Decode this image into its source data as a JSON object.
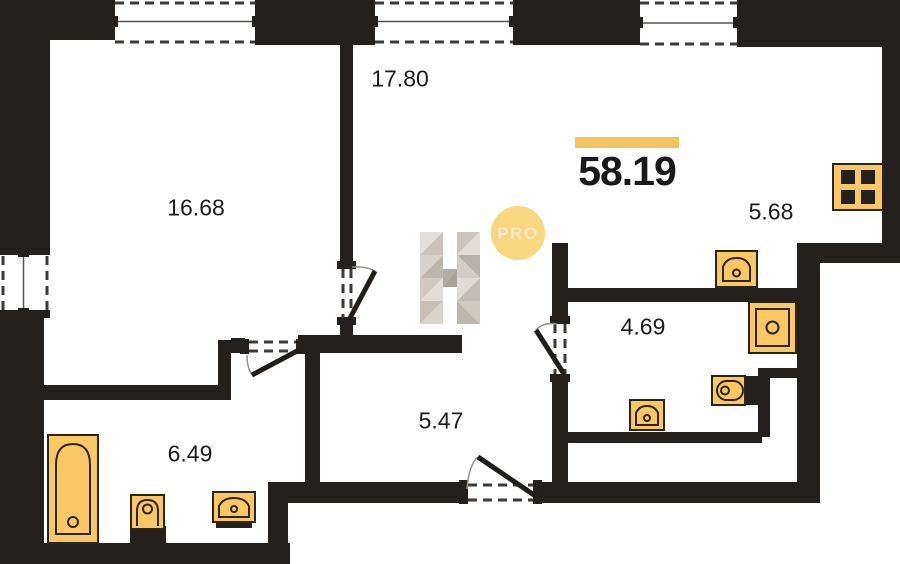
{
  "plan": {
    "type": "apartment-floor-plan",
    "total_area": "58.19",
    "room_areas": [
      {
        "id": "room-1",
        "area": "16.68",
        "cx": 196,
        "cy": 208
      },
      {
        "id": "room-2",
        "area": "17.80",
        "cx": 400,
        "cy": 79
      },
      {
        "id": "room-3",
        "area": "5.68",
        "cx": 771,
        "cy": 212
      },
      {
        "id": "room-4",
        "area": "4.69",
        "cx": 643,
        "cy": 327
      },
      {
        "id": "room-5",
        "area": "5.47",
        "cx": 441,
        "cy": 421
      },
      {
        "id": "room-6",
        "area": "6.49",
        "cx": 190,
        "cy": 454
      }
    ],
    "fixtures": [
      "bathtub",
      "toilet",
      "wash-basin",
      "kitchen-sink",
      "shower",
      "toilet",
      "wash-basin",
      "stove"
    ]
  },
  "watermark": {
    "letter": "H",
    "badge": "PRO"
  },
  "colors": {
    "wall": "#24201D",
    "fixture": "#F9C763",
    "fixtureStroke": "#2E2414",
    "accent": "#F5C45E",
    "badge": "#F8D77E",
    "badgeText": "#F0E7D0"
  }
}
